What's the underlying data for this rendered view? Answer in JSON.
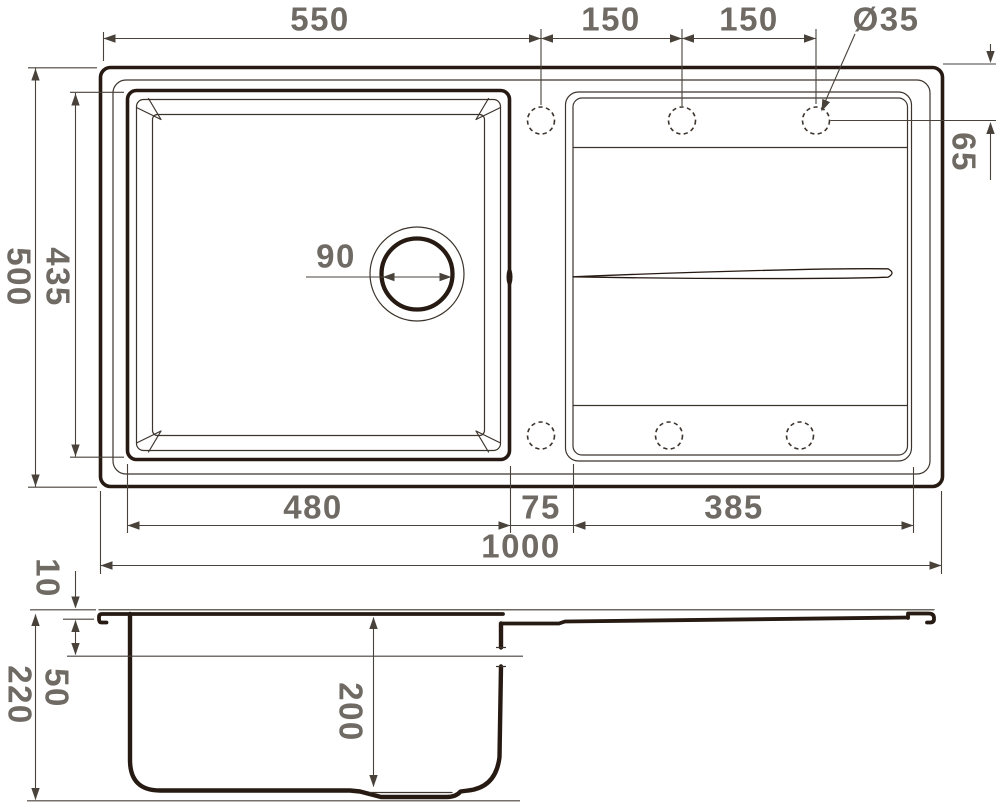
{
  "drawing": {
    "kind": "kitchen-sink-technical-drawing",
    "views": {
      "plan": "top view",
      "section": "front section view"
    }
  },
  "labels": {
    "plan": {
      "edge_to_first_hole": "550",
      "hole_pitch_1": "150",
      "hole_pitch_2": "150",
      "hole_diameter": "Ø35",
      "overall_depth": "500",
      "bowl_cutout_depth": "435",
      "drain_diameter": "90",
      "hole_center_offset": "65",
      "bowl_width": "480",
      "deck_width": "75",
      "drainboard_width": "385",
      "overall_width": "1000"
    },
    "section": {
      "rim_height": "10",
      "overall_height": "220",
      "ledge_depth": "50",
      "bowl_depth": "200"
    }
  },
  "colors": {
    "outline_ink": "#261a12",
    "thin_line": "#3c342c",
    "dimension_line": "#49423b",
    "dimension_text": "#6f6a64",
    "background": "#ffffff"
  }
}
